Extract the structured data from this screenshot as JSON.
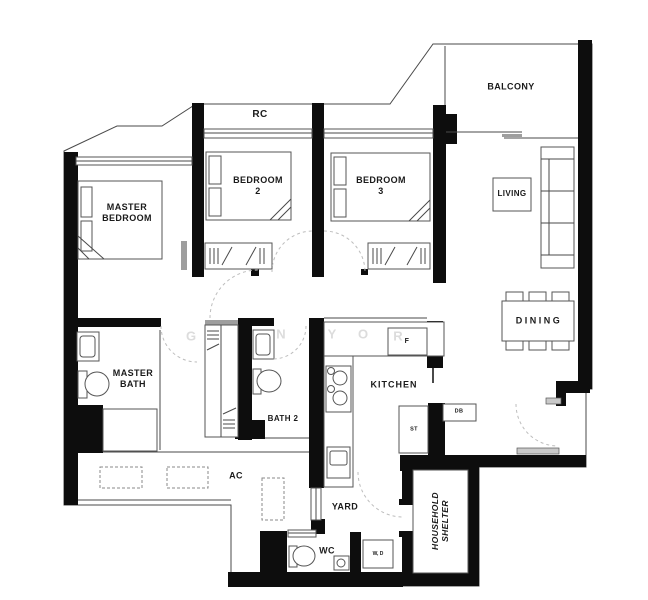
{
  "colors": {
    "wall": "#0d0d0d",
    "line": "#4a4a4a",
    "furniture": "#555555",
    "door_arc": "#bdbdbd",
    "label": "#1a1a1a",
    "watermark": "#dcdcdc",
    "window_sill": "#9e9e9e"
  },
  "labels": {
    "rc": "RC",
    "master_bedroom": {
      "l1": "MASTER",
      "l2": "BEDROOM"
    },
    "bedroom2": {
      "l1": "BEDROOM",
      "l2": "2"
    },
    "bedroom3": {
      "l1": "BEDROOM",
      "l2": "3"
    },
    "balcony": "BALCONY",
    "living": "LIVING",
    "dining": "DINING",
    "master_bath": {
      "l1": "MASTER",
      "l2": "BATH"
    },
    "bath2": "BATH 2",
    "kitchen": "KITCHEN",
    "ac": "AC",
    "yard": "YARD",
    "wc": "WC",
    "washer_dryer": "W, D",
    "fridge": "F",
    "store": "ST",
    "db": "DB",
    "household_shelter": {
      "l1": "HOUSEHOLD",
      "l2": "SHELTER"
    }
  },
  "watermark": [
    "G",
    "N",
    "Y",
    "O",
    "R"
  ]
}
